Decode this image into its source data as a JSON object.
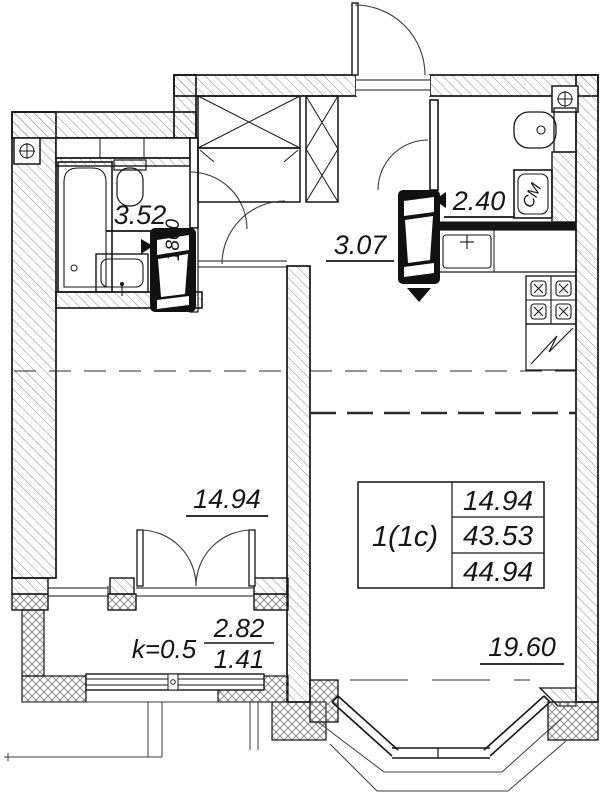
{
  "plan": {
    "rooms": [
      {
        "name": "bathroom",
        "area": "3.52"
      },
      {
        "name": "hallway",
        "area": "3.07"
      },
      {
        "name": "toilet",
        "area": "2.40"
      },
      {
        "name": "living-room",
        "area": "14.94"
      },
      {
        "name": "kitchen-living-room",
        "area": "19.60"
      }
    ],
    "balcony": {
      "coefficient": "k=0.5",
      "numerator": "2.82",
      "denominator": "1.41"
    },
    "info_table": {
      "unit_type": "1(1c)",
      "rows": [
        "14.94",
        "43.53",
        "44.94"
      ]
    },
    "annotations": {
      "bathtub_length": "1800",
      "washing_machine": "СМ"
    }
  }
}
